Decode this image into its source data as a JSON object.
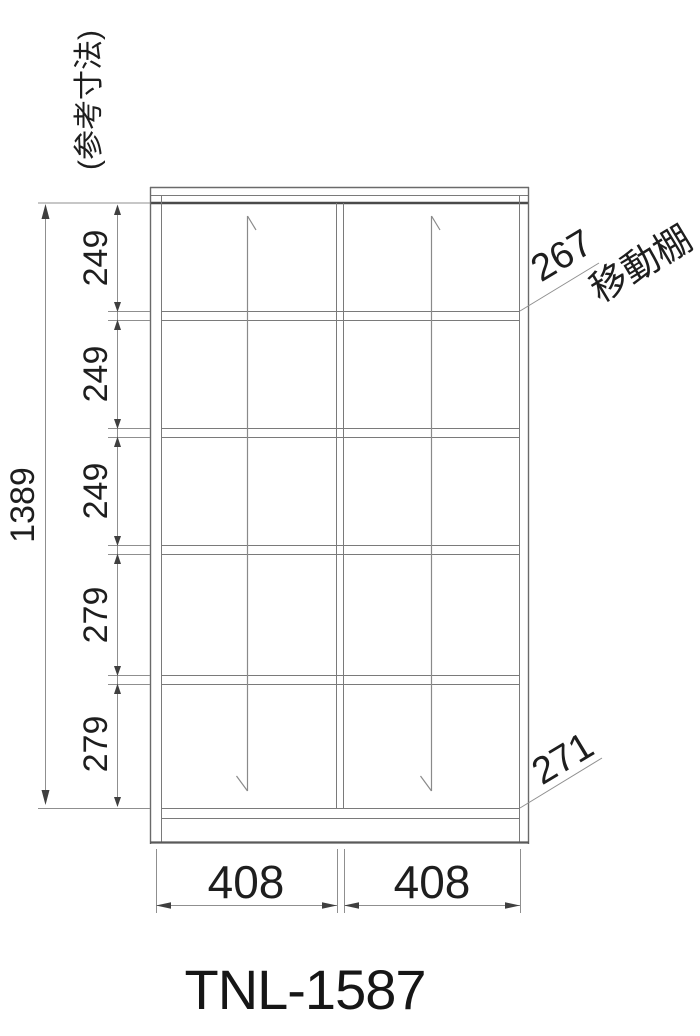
{
  "meta": {
    "model": "TNL-1587",
    "reference_note": "(参考寸法)"
  },
  "colors": {
    "background": "#ffffff",
    "frame_line": "#6a6a6a",
    "thin_line": "#7a7a7a",
    "dark_line": "#4a4a4a",
    "dimension_line": "#8f8f8f",
    "arrow_fill": "#3f3f3f",
    "text": "#1e1e1e"
  },
  "dimensions": {
    "overall_height": "1389",
    "left_segments": [
      "249",
      "249",
      "249",
      "279",
      "279"
    ],
    "column_widths": [
      "408",
      "408"
    ],
    "leaders": {
      "movable_shelf_value": "267",
      "movable_shelf_label": "移動棚",
      "bottom_shelf_value": "271"
    }
  }
}
